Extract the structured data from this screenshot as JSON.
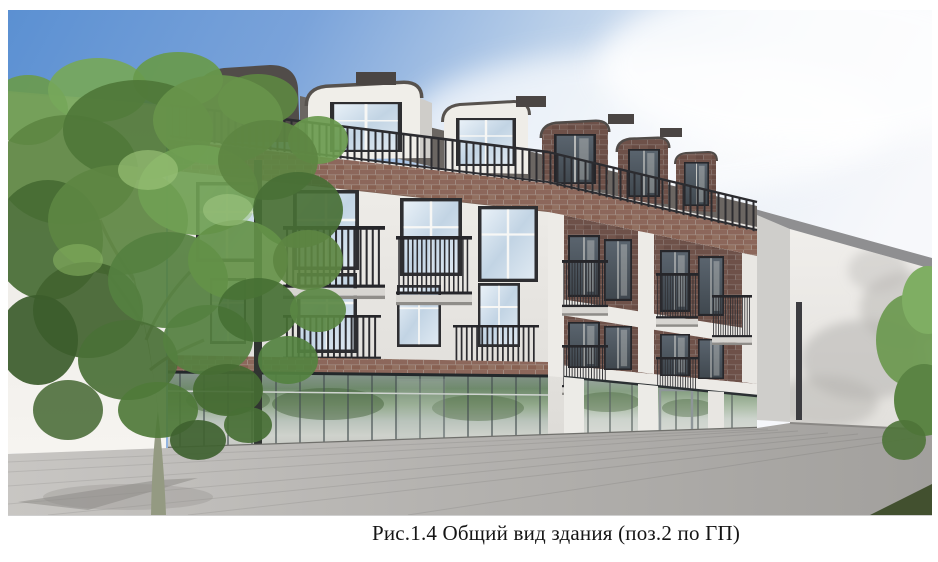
{
  "figure": {
    "caption": "Рис.1.4 Общий вид здания (поз.2 по ГП)",
    "figure_label": "Рис.1.4",
    "figure_title": "Общий вид здания (поз.2 по ГП)"
  },
  "palette": {
    "sky_blue": "#5b90d2",
    "facade_white": "#efede9",
    "brick_light": "#8c675b",
    "brick_dark": "#6e5149",
    "roof_gray": "#514c49",
    "railing_dark": "#2c2c30",
    "pavement_gray": "#b5b3b0",
    "foliage_green": "#5d8542",
    "grass_dark": "#42502f",
    "caption_color": "#151515"
  }
}
